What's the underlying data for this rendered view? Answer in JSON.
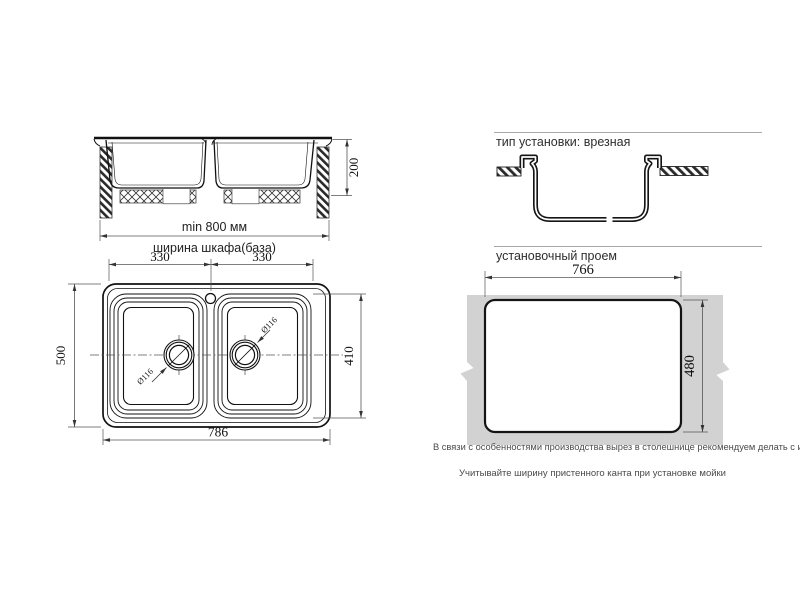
{
  "front_view": {
    "bowl_depth": "200",
    "cabinet_min": "min 800 мм",
    "cabinet_caption": "ширина шкафа(база)"
  },
  "install_type": {
    "heading": "тип установки: врезная"
  },
  "top_view": {
    "left_bowl_width": "330",
    "right_bowl_width": "330",
    "overall_depth": "500",
    "bowls_length": "410",
    "overall_width": "786",
    "left_drain_diameter": "Ø116",
    "right_drain_diameter": "Ø116"
  },
  "cutout_view": {
    "heading": "установочный проем",
    "width": "766",
    "depth": "480",
    "note_production": "В связи с особенностями производства вырез в столешнице рекомендуем делать с изделия.",
    "note_install": "Учитывайте ширину пристенного канта при установке мойки"
  },
  "colors": {
    "line": "#1a1a1a",
    "dimension": "#555555",
    "rule": "#a8a8a8",
    "countertop": "#d2d2d2"
  }
}
